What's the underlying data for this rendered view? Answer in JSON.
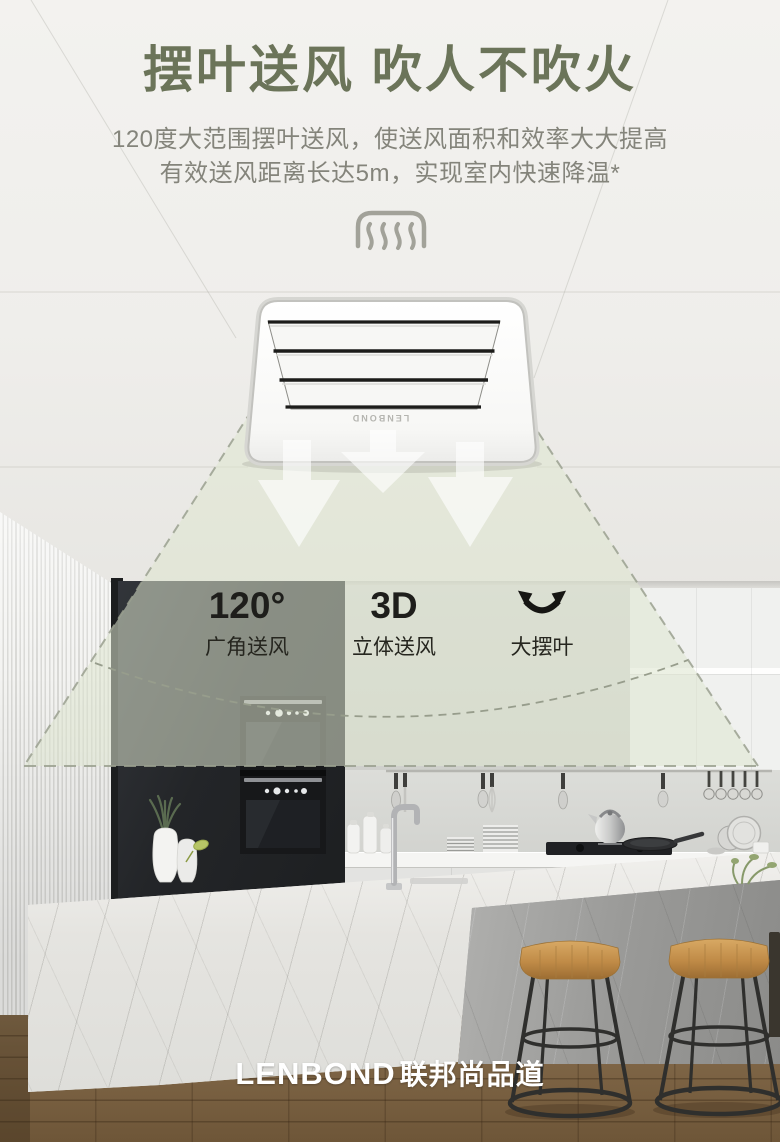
{
  "header": {
    "title": "摆叶送风 吹人不吹火",
    "subtitle_line1": "120度大范围摆叶送风，使送风面积和效率大大提高",
    "subtitle_line2": "有效送风距离长达5m，实现室内快速降温*"
  },
  "product": {
    "brand_label": "LENBOND"
  },
  "features": [
    {
      "value": "120°",
      "label": "广角送风"
    },
    {
      "value": "3D",
      "label": "立体送风"
    },
    {
      "value": "",
      "label": "大摆叶",
      "icon": "swing-arrows-icon"
    }
  ],
  "footer": {
    "logo_en": "LENBOND",
    "logo_cn": "联邦尚品道"
  },
  "colors": {
    "title_green": "#6b7459",
    "cone_tint": "#dfe5cf",
    "dark_cabinet": "#232528",
    "wood_floor": "#7c6344",
    "logo_white": "#ffffff"
  }
}
